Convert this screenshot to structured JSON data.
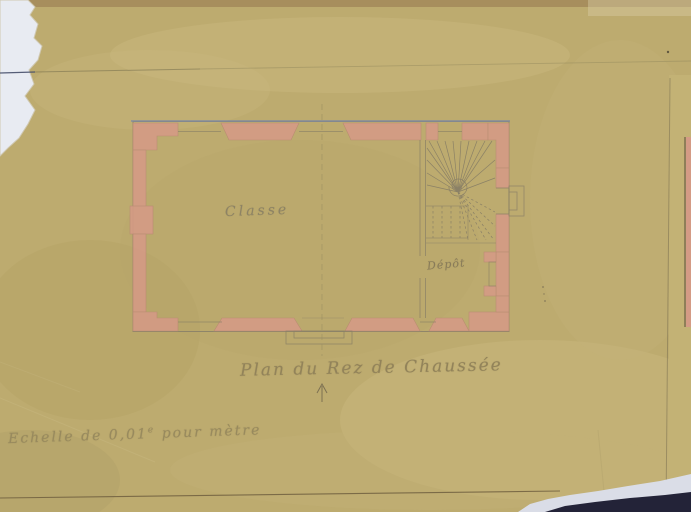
{
  "drawing": {
    "caption": "Plan du Rez de Chaussée",
    "rooms": {
      "main": "Classe",
      "store": "Dépôt"
    },
    "scale": {
      "prefix": "Echelle de 0,01",
      "sup": "e",
      "suffix": " pour mètre"
    }
  },
  "colors": {
    "scanner_background": "#e7eaf1",
    "paper": "#bdab6f",
    "wall_poche_pink": "#d49b85",
    "ink_line": "#8b8166",
    "outer_line_blue": "#7e8aa3",
    "handwriting_pencil": "#857d64",
    "handwriting_ink": "#92835a",
    "bottom_dark_strip": "#232338"
  }
}
